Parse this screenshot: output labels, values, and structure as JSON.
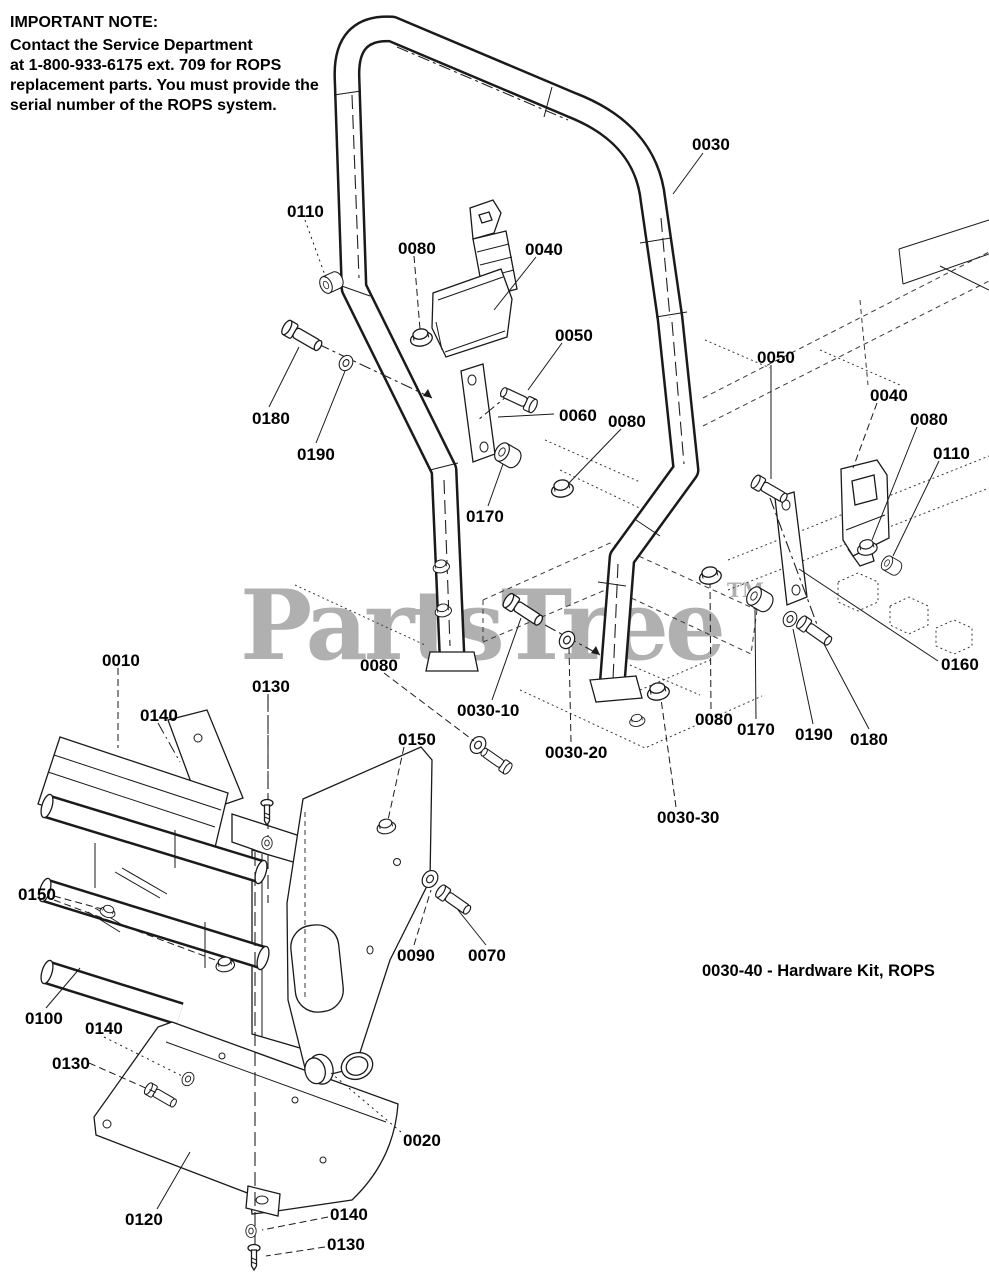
{
  "note": {
    "title": "IMPORTANT NOTE:",
    "lines": [
      "Contact the Service Department",
      "at 1-800-933-6175 ext. 709 for ROPS",
      "replacement parts. You must provide the",
      "serial number of the ROPS system."
    ]
  },
  "watermark": {
    "text": "PartsTree",
    "tm": "TM",
    "color": "#b0b0b0"
  },
  "hardware_kit_note": "0030-40 - Hardware Kit, ROPS",
  "diagram": {
    "description": "Exploded view - ROPS roll bar, seat belt and mounting hardware",
    "line_color": "#1a1a1a",
    "background": "#ffffff"
  },
  "callouts": [
    {
      "label": "0030",
      "x": 692,
      "y": 136,
      "leaders": [
        [
          703,
          153,
          673,
          194,
          "solid"
        ]
      ]
    },
    {
      "label": "0110",
      "x": 287,
      "y": 203,
      "leaders": [
        [
          305,
          220,
          326,
          278,
          "dotted"
        ]
      ]
    },
    {
      "label": "0080",
      "x": 398,
      "y": 240,
      "leaders": [
        [
          414,
          256,
          420,
          329,
          "dashed"
        ]
      ]
    },
    {
      "label": "0040",
      "x": 525,
      "y": 241,
      "leaders": [
        [
          536,
          257,
          494,
          310,
          "solid"
        ]
      ]
    },
    {
      "label": "0050",
      "x": 555,
      "y": 327,
      "leaders": [
        [
          562,
          343,
          528,
          390,
          "solid"
        ]
      ]
    },
    {
      "label": "0180",
      "x": 252,
      "y": 410,
      "leaders": [
        [
          269,
          407,
          299,
          347,
          "solid"
        ]
      ]
    },
    {
      "label": "0190",
      "x": 297,
      "y": 446,
      "leaders": [
        [
          316,
          443,
          345,
          371,
          "solid"
        ]
      ]
    },
    {
      "label": "0060",
      "x": 559,
      "y": 407,
      "leaders": [
        [
          554,
          414,
          498,
          417,
          "solid"
        ]
      ]
    },
    {
      "label": "0080",
      "x": 608,
      "y": 413,
      "leaders": [
        [
          621,
          429,
          569,
          483,
          "solid"
        ]
      ]
    },
    {
      "label": "0170",
      "x": 466,
      "y": 508,
      "leaders": [
        [
          488,
          506,
          503,
          464,
          "solid"
        ]
      ]
    },
    {
      "label": "0050",
      "x": 757,
      "y": 349,
      "leaders": [
        [
          771,
          365,
          771,
          479,
          "solid"
        ]
      ]
    },
    {
      "label": "0040",
      "x": 870,
      "y": 387,
      "leaders": [
        [
          877,
          403,
          853,
          468,
          "dashed"
        ]
      ]
    },
    {
      "label": "0080",
      "x": 910,
      "y": 411,
      "leaders": [
        [
          917,
          427,
          872,
          540,
          "solid"
        ]
      ]
    },
    {
      "label": "0110",
      "x": 933,
      "y": 445,
      "leaders": [
        [
          939,
          461,
          893,
          556,
          "solid"
        ]
      ]
    },
    {
      "label": "0160",
      "x": 941,
      "y": 656,
      "leaders": [
        [
          938,
          661,
          799,
          569,
          "solid"
        ]
      ]
    },
    {
      "label": "0010",
      "x": 102,
      "y": 652,
      "leaders": [
        [
          118,
          668,
          118,
          748,
          "dashed"
        ]
      ]
    },
    {
      "label": "0130",
      "x": 252,
      "y": 678,
      "leaders": [
        [
          268,
          694,
          268,
          802,
          "dashed"
        ]
      ]
    },
    {
      "label": "0140",
      "x": 140,
      "y": 707,
      "leaders": [
        [
          158,
          723,
          180,
          762,
          "dashdot"
        ]
      ]
    },
    {
      "label": "0080",
      "x": 360,
      "y": 657,
      "leaders": [
        [
          384,
          673,
          474,
          741,
          "dashed"
        ]
      ]
    },
    {
      "label": "0150",
      "x": 398,
      "y": 731,
      "leaders": [
        [
          404,
          747,
          388,
          820,
          "dashed"
        ]
      ]
    },
    {
      "label": "0030-10",
      "x": 457,
      "y": 702,
      "leaders": [
        [
          492,
          700,
          521,
          618,
          "solid"
        ]
      ]
    },
    {
      "label": "0030-20",
      "x": 545,
      "y": 744,
      "leaders": [
        [
          571,
          742,
          569,
          648,
          "dashed"
        ]
      ]
    },
    {
      "label": "0080",
      "x": 695,
      "y": 711,
      "leaders": [
        [
          711,
          709,
          710,
          584,
          "dashed"
        ]
      ]
    },
    {
      "label": "0170",
      "x": 737,
      "y": 721,
      "leaders": [
        [
          756,
          719,
          755,
          610,
          "solid"
        ]
      ]
    },
    {
      "label": "0190",
      "x": 795,
      "y": 726,
      "leaders": [
        [
          813,
          724,
          793,
          629,
          "solid"
        ]
      ]
    },
    {
      "label": "0180",
      "x": 850,
      "y": 731,
      "leaders": [
        [
          869,
          729,
          824,
          644,
          "solid"
        ]
      ]
    },
    {
      "label": "0030-30",
      "x": 657,
      "y": 809,
      "leaders": [
        [
          676,
          807,
          661,
          699,
          "dashed"
        ]
      ]
    },
    {
      "label": "0150",
      "x": 18,
      "y": 886,
      "leaders": [
        [
          54,
          896,
          102,
          909,
          "dashed"
        ],
        [
          54,
          900,
          218,
          961,
          "dashed"
        ]
      ]
    },
    {
      "label": "0100",
      "x": 25,
      "y": 1010,
      "leaders": [
        [
          46,
          1008,
          80,
          968,
          "solid"
        ]
      ]
    },
    {
      "label": "0140",
      "x": 85,
      "y": 1020,
      "leaders": [
        [
          104,
          1037,
          184,
          1077,
          "dotted"
        ]
      ]
    },
    {
      "label": "0130",
      "x": 52,
      "y": 1055,
      "leaders": [
        [
          89,
          1063,
          157,
          1093,
          "dashed"
        ]
      ]
    },
    {
      "label": "0090",
      "x": 397,
      "y": 947,
      "leaders": [
        [
          414,
          945,
          431,
          890,
          "dashed"
        ]
      ]
    },
    {
      "label": "0070",
      "x": 468,
      "y": 947,
      "leaders": [
        [
          486,
          945,
          458,
          910,
          "solid"
        ]
      ]
    },
    {
      "label": "0020",
      "x": 403,
      "y": 1132,
      "leaders": [
        [
          401,
          1132,
          331,
          1073,
          "dotted"
        ]
      ]
    },
    {
      "label": "0120",
      "x": 125,
      "y": 1211,
      "leaders": [
        [
          157,
          1209,
          190,
          1152,
          "solid"
        ]
      ]
    },
    {
      "label": "0140",
      "x": 330,
      "y": 1206,
      "leaders": [
        [
          328,
          1217,
          262,
          1230,
          "dashed"
        ]
      ]
    },
    {
      "label": "0130",
      "x": 327,
      "y": 1236,
      "leaders": [
        [
          325,
          1247,
          266,
          1256,
          "dashed"
        ]
      ]
    }
  ]
}
